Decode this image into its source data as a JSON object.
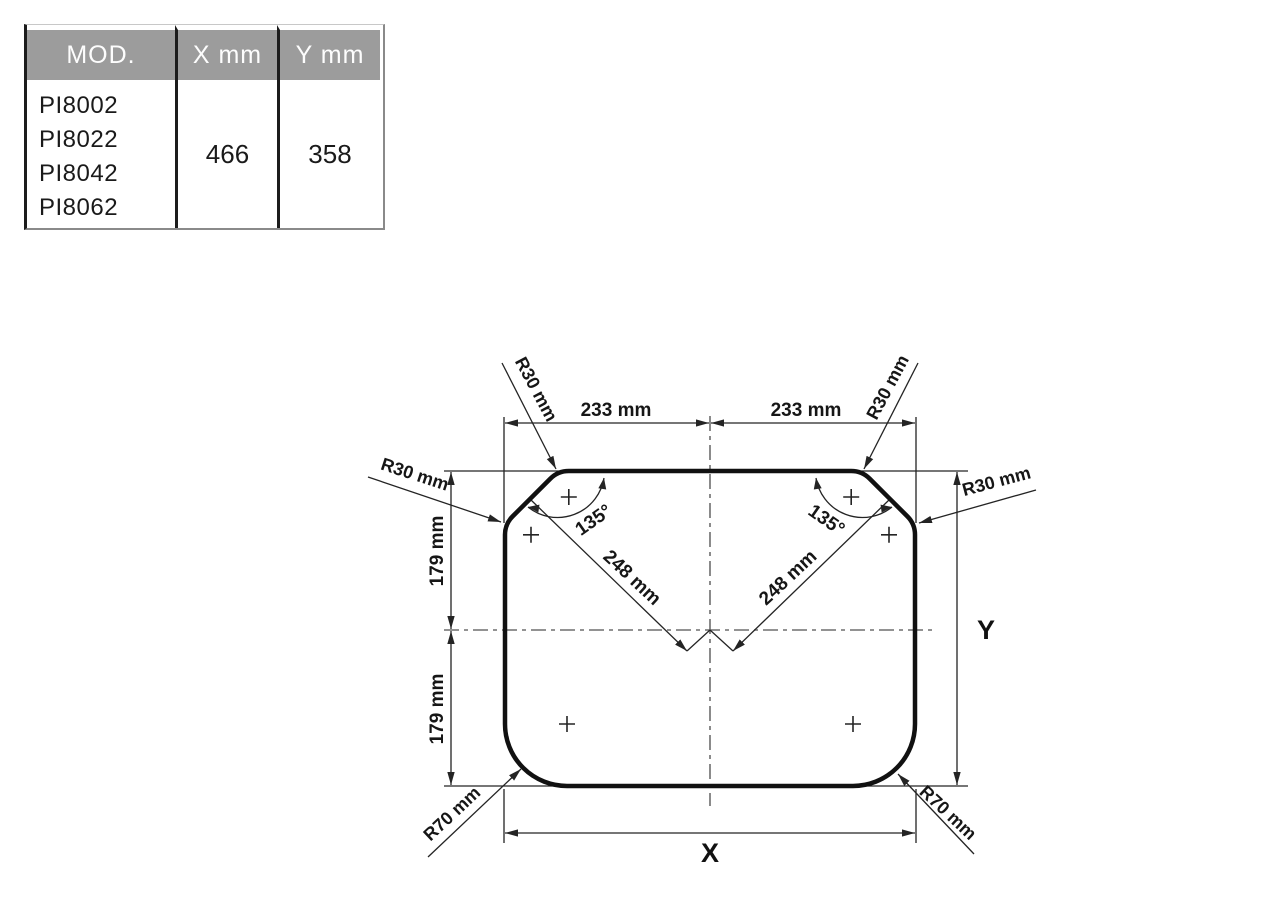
{
  "table": {
    "header": {
      "mod": "MOD.",
      "x": "X mm",
      "y": "Y mm"
    },
    "models": [
      "PI8002",
      "PI8022",
      "PI8042",
      "PI8062"
    ],
    "x_value": "466",
    "y_value": "358"
  },
  "drawing": {
    "dim_233_left": "233 mm",
    "dim_233_right": "233 mm",
    "dim_179_upper": "179 mm",
    "dim_179_lower": "179 mm",
    "dim_248_left": "248 mm",
    "dim_248_right": "248 mm",
    "angle_left": "135°",
    "angle_right": "135°",
    "radius_top_left": "R30 mm",
    "radius_top_right": "R30 mm",
    "radius_left": "R30 mm",
    "radius_right": "R30 mm",
    "radius_bottom_left": "R70 mm",
    "radius_bottom_right": "R70 mm",
    "axis_x": "X",
    "axis_y": "Y"
  },
  "colors": {
    "outline": "#111111",
    "dimension_lines": "#242424",
    "centerline": "#6e6e6e",
    "table_header_bg": "#9c9c9c",
    "table_header_text": "#fdfdfd",
    "table_border": "#1c1c1c"
  }
}
